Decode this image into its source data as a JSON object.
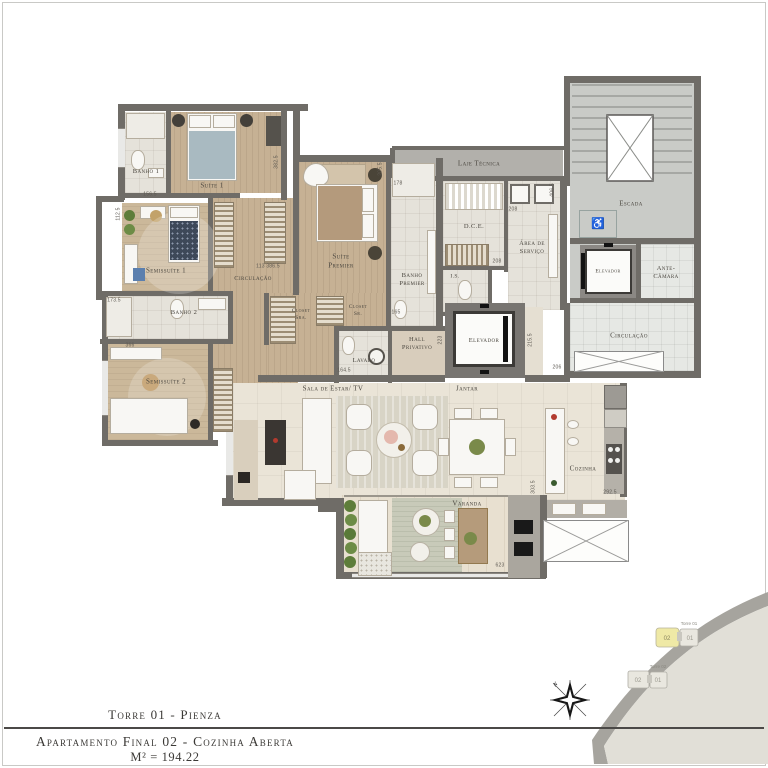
{
  "footer": {
    "torre": "Torre 01 - Pienza",
    "apartamento": "Apartamento Final 02 - Cozinha Aberta",
    "area": "M² = 194.22"
  },
  "rooms": {
    "banho1": "Banho 1",
    "suite1": "Suíte 1",
    "semissuite1": "Semissuíte 1",
    "circulacao": "Circulação",
    "suite_premier": "Suíte\nPremier",
    "closet_sra": "Closet\nSra.",
    "closet_sr": "Closet\nSr.",
    "banho_premier": "Banho\nPremier",
    "laje_tecnica": "Laje Técnica",
    "dce": "D.C.E.",
    "area_servico": "Área de\nServiço",
    "is": "I.S.",
    "escada": "Escada",
    "elevador_servico": "Elevador",
    "ante_camara": "Ante-\nCâmara",
    "circulacao_core": "Circulação",
    "hall_privativo": "Hall\nPrivativo",
    "lavabo": "Lavabo",
    "elevador_privativo": "Elevador",
    "banho2": "Banho 2",
    "semissuite2": "Semissuíte 2",
    "sala": "Sala de Estar/ TV",
    "jantar": "Jantar",
    "cozinha": "Cozinha",
    "varanda": "Varanda"
  },
  "dims": {
    "a": "156.5",
    "b": "382.5",
    "c": "112.5",
    "d": "113  386.5",
    "e": "173.5",
    "f": "366",
    "g": "178",
    "h": "406.5",
    "i": "208",
    "j": "208",
    "k": "206",
    "l": "223",
    "m": "215.5",
    "n": "303.5",
    "o": "292.5",
    "p": "623",
    "q": "164.5",
    "r": "165",
    "s": "205.5"
  },
  "keyplan": {
    "tower1": "Torre 01",
    "tower2": "Torre 02",
    "unit01": "01",
    "unit02": "02"
  },
  "compass": {
    "north": "N"
  },
  "icons": {
    "accessible": "♿"
  },
  "colors": {
    "wall": "#6f6c67",
    "wood": "#c6b194",
    "highlight_unit": "#efe9a6",
    "footer_text": "#3b3936"
  }
}
